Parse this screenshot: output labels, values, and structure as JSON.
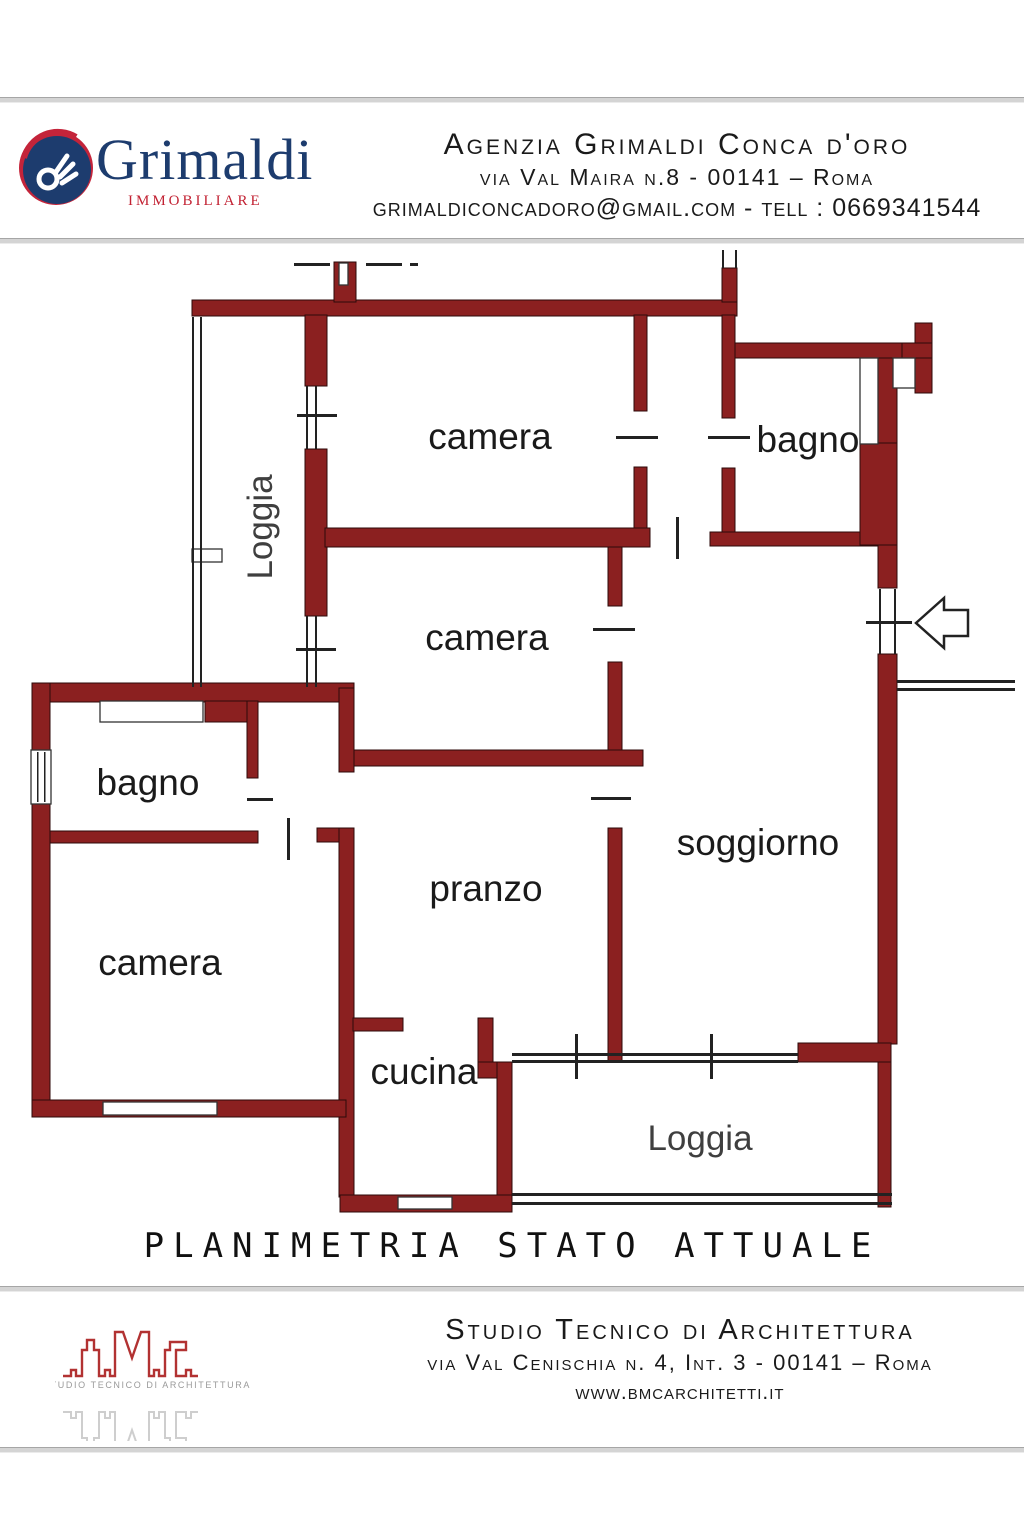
{
  "header": {
    "logo": {
      "name": "Grimaldi",
      "subtitle": "IMMOBILIARE"
    },
    "agency_line1": "Agenzia Grimaldi Conca d'oro",
    "agency_line2": "via Val Maira n.8  - 00141 – Roma",
    "agency_line3": "grimaldiconcadoro@gmail.com - tell : 0669341544"
  },
  "plan": {
    "rooms": {
      "camera_top": "camera",
      "bagno_top": "bagno",
      "loggia_left": "Loggia",
      "camera_mid": "camera",
      "bagno_left": "bagno",
      "camera_bottom": "camera",
      "pranzo": "pranzo",
      "soggiorno": "soggiorno",
      "cucina": "cucina",
      "loggia_bottom": "Loggia"
    },
    "icons": {
      "entrance_arrow": "left-arrow"
    }
  },
  "title": "PLANIMETRIA STATO ATTUALE",
  "footer": {
    "logo_subtext": "STUDIO TECNICO DI ARCHITETTURA",
    "line1": "Studio Tecnico di Architettura",
    "line2": "via Val Cenischia n. 4, Int. 3 - 00141 – Roma",
    "line3": "www.bmcarchitetti.it"
  },
  "colors": {
    "wall": "#8b2020",
    "logo_navy": "#1d3c6e",
    "logo_red": "#c22233",
    "divider_gray": "#d4d4d4"
  }
}
